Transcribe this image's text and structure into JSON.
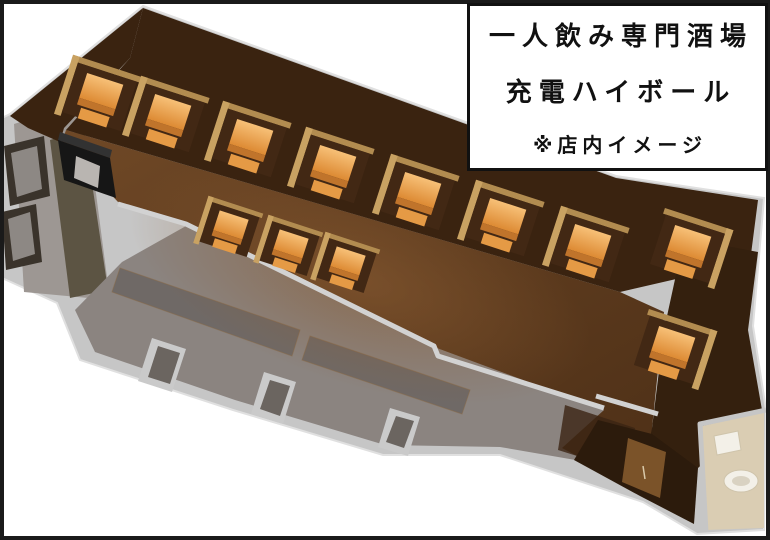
{
  "overlay": {
    "line1": "一人飲み専門酒場",
    "line2": "充電ハイボール",
    "line3": "※店内イメージ"
  },
  "palette": {
    "frame": "#1a1a1a",
    "background": "#ffffff",
    "outer_wall": "#c6c6c6",
    "wall_highlight": "#e0e0e0",
    "wall_line": "#d2d2d2",
    "wood_light": "#6f4826",
    "wood_dark": "#4e3017",
    "wood_glow": "#8a5c33",
    "dark_wall": "#3a2310",
    "dark_wall_right": "#34200e",
    "kitchen_floor": "#8b8480",
    "kitchen_counter": "#6f6966",
    "left_room_floor": "#9d9793",
    "door_frame": "#3a332b",
    "door_panel": "#8d8884",
    "olive_wall": "#5c5443",
    "black_counter": "#161616",
    "black_counter_top": "#323232",
    "black_counter_panel": "#b9b5b1",
    "vestibule": "#2c1b0c",
    "vestibule_door": "#7b5329",
    "restroom_floor": "#dacdb3",
    "toilet": "#f3f0e8",
    "toilet_shadow": "#d9d2c2",
    "booth_back": "#422814",
    "partition": "#c9a262",
    "partition_dark": "#b28c50",
    "table_light": "#f7c077",
    "table_dark": "#dd8a33",
    "table_front": "#c0742b",
    "seat": "#e59a45",
    "door_tab": "#cacaca",
    "door_tab_inner": "#6b6560"
  },
  "floorplan": {
    "booth_count": 12,
    "booths": [
      {
        "x": 100,
        "y": 95,
        "flip": false,
        "s": 1
      },
      {
        "x": 168,
        "y": 116,
        "flip": false,
        "s": 1
      },
      {
        "x": 250,
        "y": 141,
        "flip": false,
        "s": 1
      },
      {
        "x": 333,
        "y": 167,
        "flip": false,
        "s": 1
      },
      {
        "x": 418,
        "y": 194,
        "flip": false,
        "s": 1
      },
      {
        "x": 503,
        "y": 220,
        "flip": false,
        "s": 1
      },
      {
        "x": 588,
        "y": 246,
        "flip": false,
        "s": 1
      },
      {
        "x": 688,
        "y": 247,
        "flip": true,
        "s": 1
      },
      {
        "x": 672,
        "y": 348,
        "flip": true,
        "s": 1
      },
      {
        "x": 230,
        "y": 228,
        "flip": false,
        "s": 0.8
      },
      {
        "x": 290,
        "y": 247,
        "flip": false,
        "s": 0.8
      },
      {
        "x": 347,
        "y": 264,
        "flip": false,
        "s": 0.8
      }
    ]
  }
}
